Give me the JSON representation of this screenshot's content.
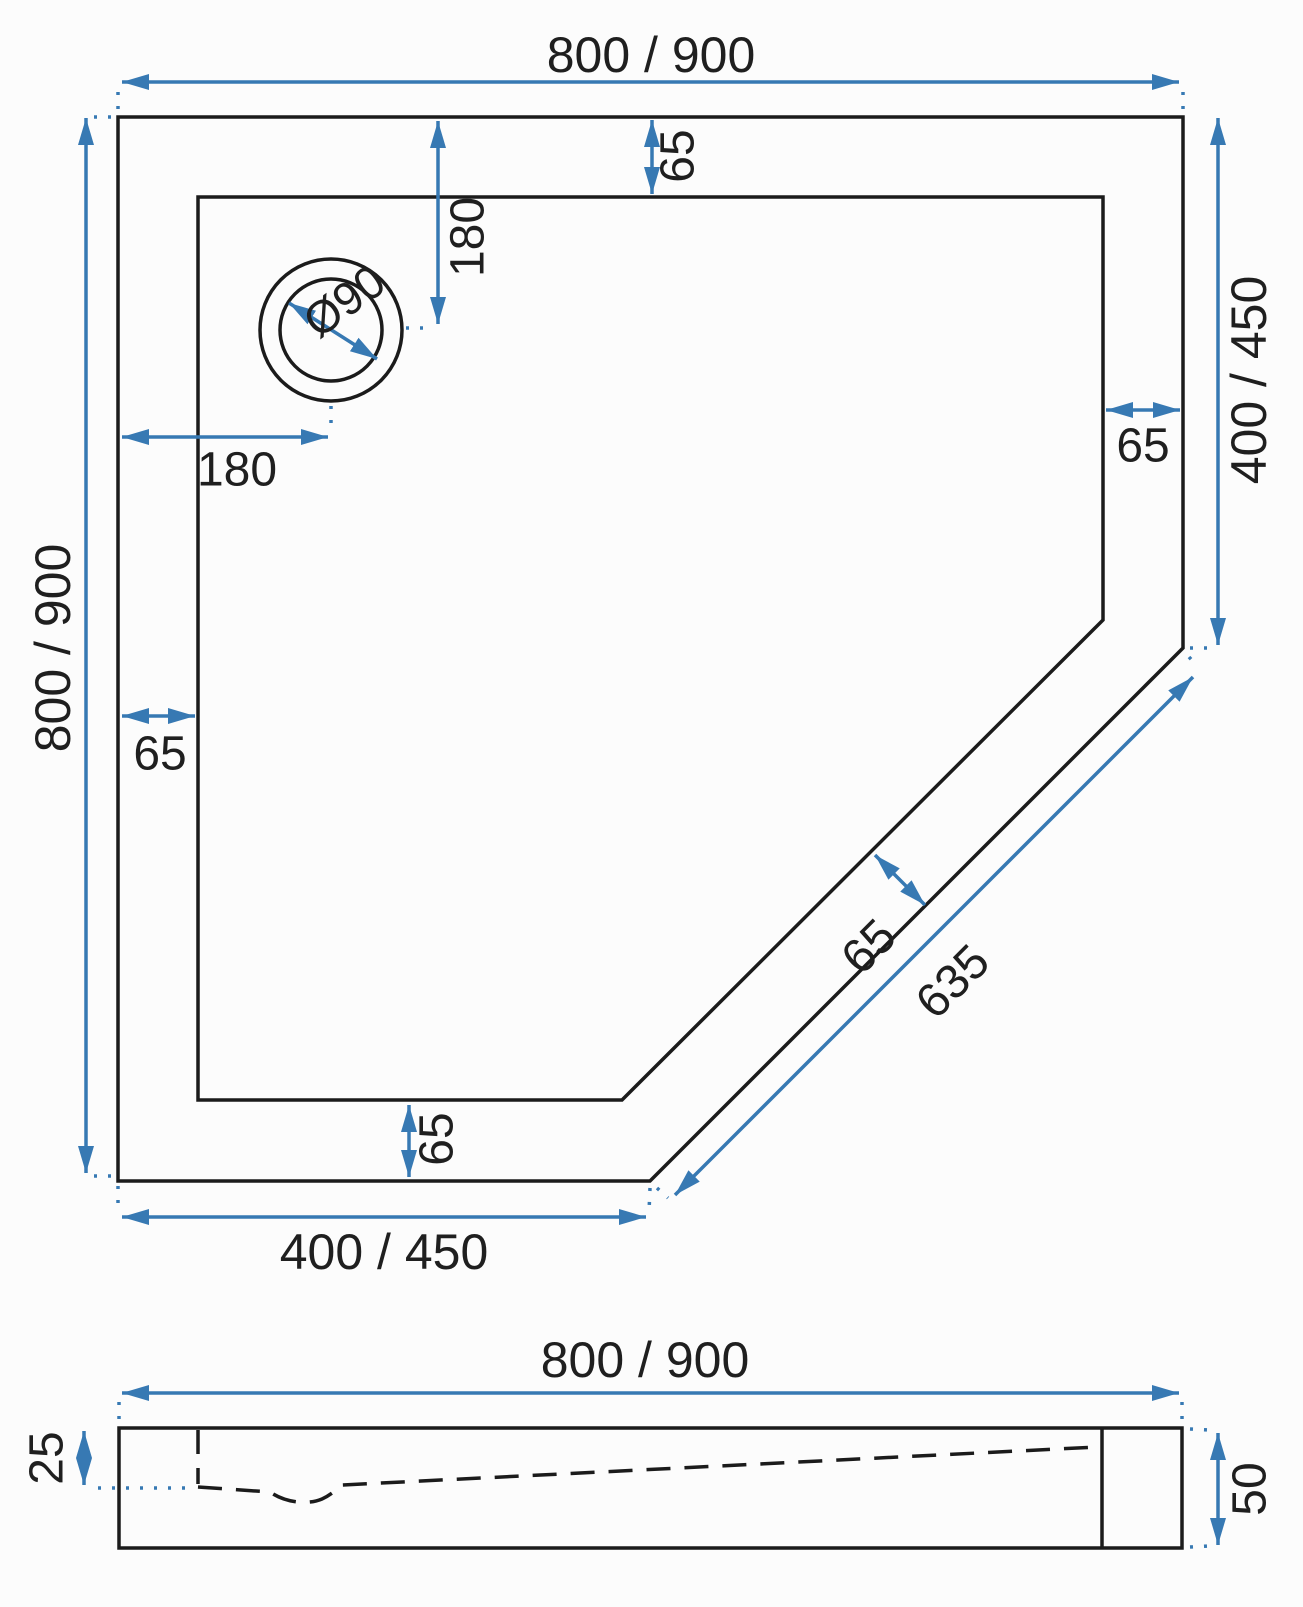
{
  "drawing": {
    "type": "shower-tray-technical-drawing",
    "colors": {
      "dimension_blue": "#3779b3",
      "outline_black": "#1b1b1b",
      "background": "#fcfcfc"
    },
    "top_view": {
      "dim_top_width": "800 / 900",
      "dim_left_height": "800 / 900",
      "dim_right_height": "400 / 450",
      "dim_bottom_width": "400 / 450",
      "dim_drain_from_top": "180",
      "dim_drain_from_left": "180",
      "dim_rim_top": "65",
      "dim_rim_right": "65",
      "dim_rim_left": "65",
      "dim_rim_bottom": "65",
      "dim_rim_diagonal": "65",
      "dim_diagonal_edge": "635",
      "dim_drain_diameter": "Ø90"
    },
    "side_view": {
      "dim_width": "800 / 900",
      "dim_inner_depth": "25",
      "dim_outer_height": "50"
    }
  }
}
